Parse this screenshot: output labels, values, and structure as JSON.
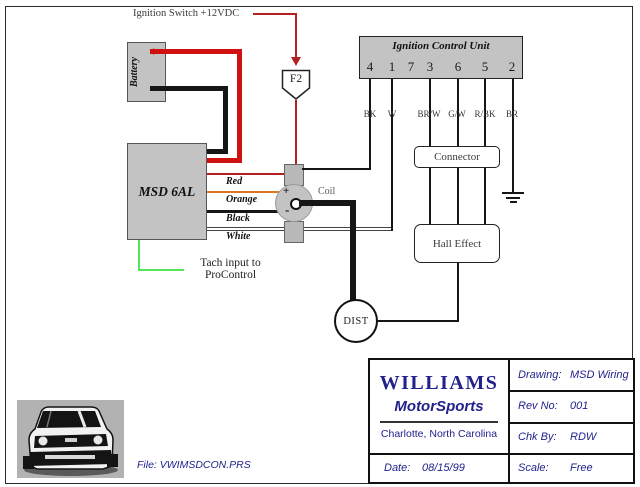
{
  "diagram": {
    "ignition_switch_label": "Ignition Switch +12VDC",
    "fuse_label": "F2",
    "battery": {
      "label": "Battery",
      "plus": "+",
      "minus": "-"
    },
    "msd_box_label": "MSD 6AL",
    "msd_wire_labels": [
      "Red",
      "Orange",
      "Black",
      "White"
    ],
    "tach_note": {
      "line1": "Tach input to",
      "line2": "ProControl"
    },
    "coil": {
      "label": "Coil",
      "plus": "+",
      "minus": "-"
    },
    "ignition_control_unit": {
      "title": "Ignition Control Unit",
      "pins": [
        "4",
        "1",
        "7",
        "3",
        "6",
        "5",
        "2"
      ],
      "wire_codes": [
        "BK",
        "W",
        "BR/W",
        "G/W",
        "R/BK",
        "BR"
      ]
    },
    "connector_label": "Connector",
    "hall_effect_label": "Hall Effect",
    "distributor_label": "DIST"
  },
  "title_block": {
    "company": "WILLIAMS",
    "division": "MotorSports",
    "location": "Charlotte, North Carolina",
    "date": {
      "label": "Date:",
      "value": "08/15/99"
    },
    "drawing": {
      "label": "Drawing:",
      "value": "MSD Wiring"
    },
    "rev": {
      "label": "Rev No:",
      "value": "001"
    },
    "chk": {
      "label": "Chk By:",
      "value": "RDW"
    },
    "scale": {
      "label": "Scale:",
      "value": "Free"
    }
  },
  "file_label": "File: VWIMSDCON.PRS",
  "colors": {
    "wire_red": "#cf1210",
    "wire_thin_red": "#b22222",
    "wire_orange": "#dd7722",
    "wire_green": "#56e356",
    "wire_black": "#161616",
    "wire_white": "#ffffff",
    "box_gray": "#c3c3c3",
    "text_navy": "#22228c"
  }
}
